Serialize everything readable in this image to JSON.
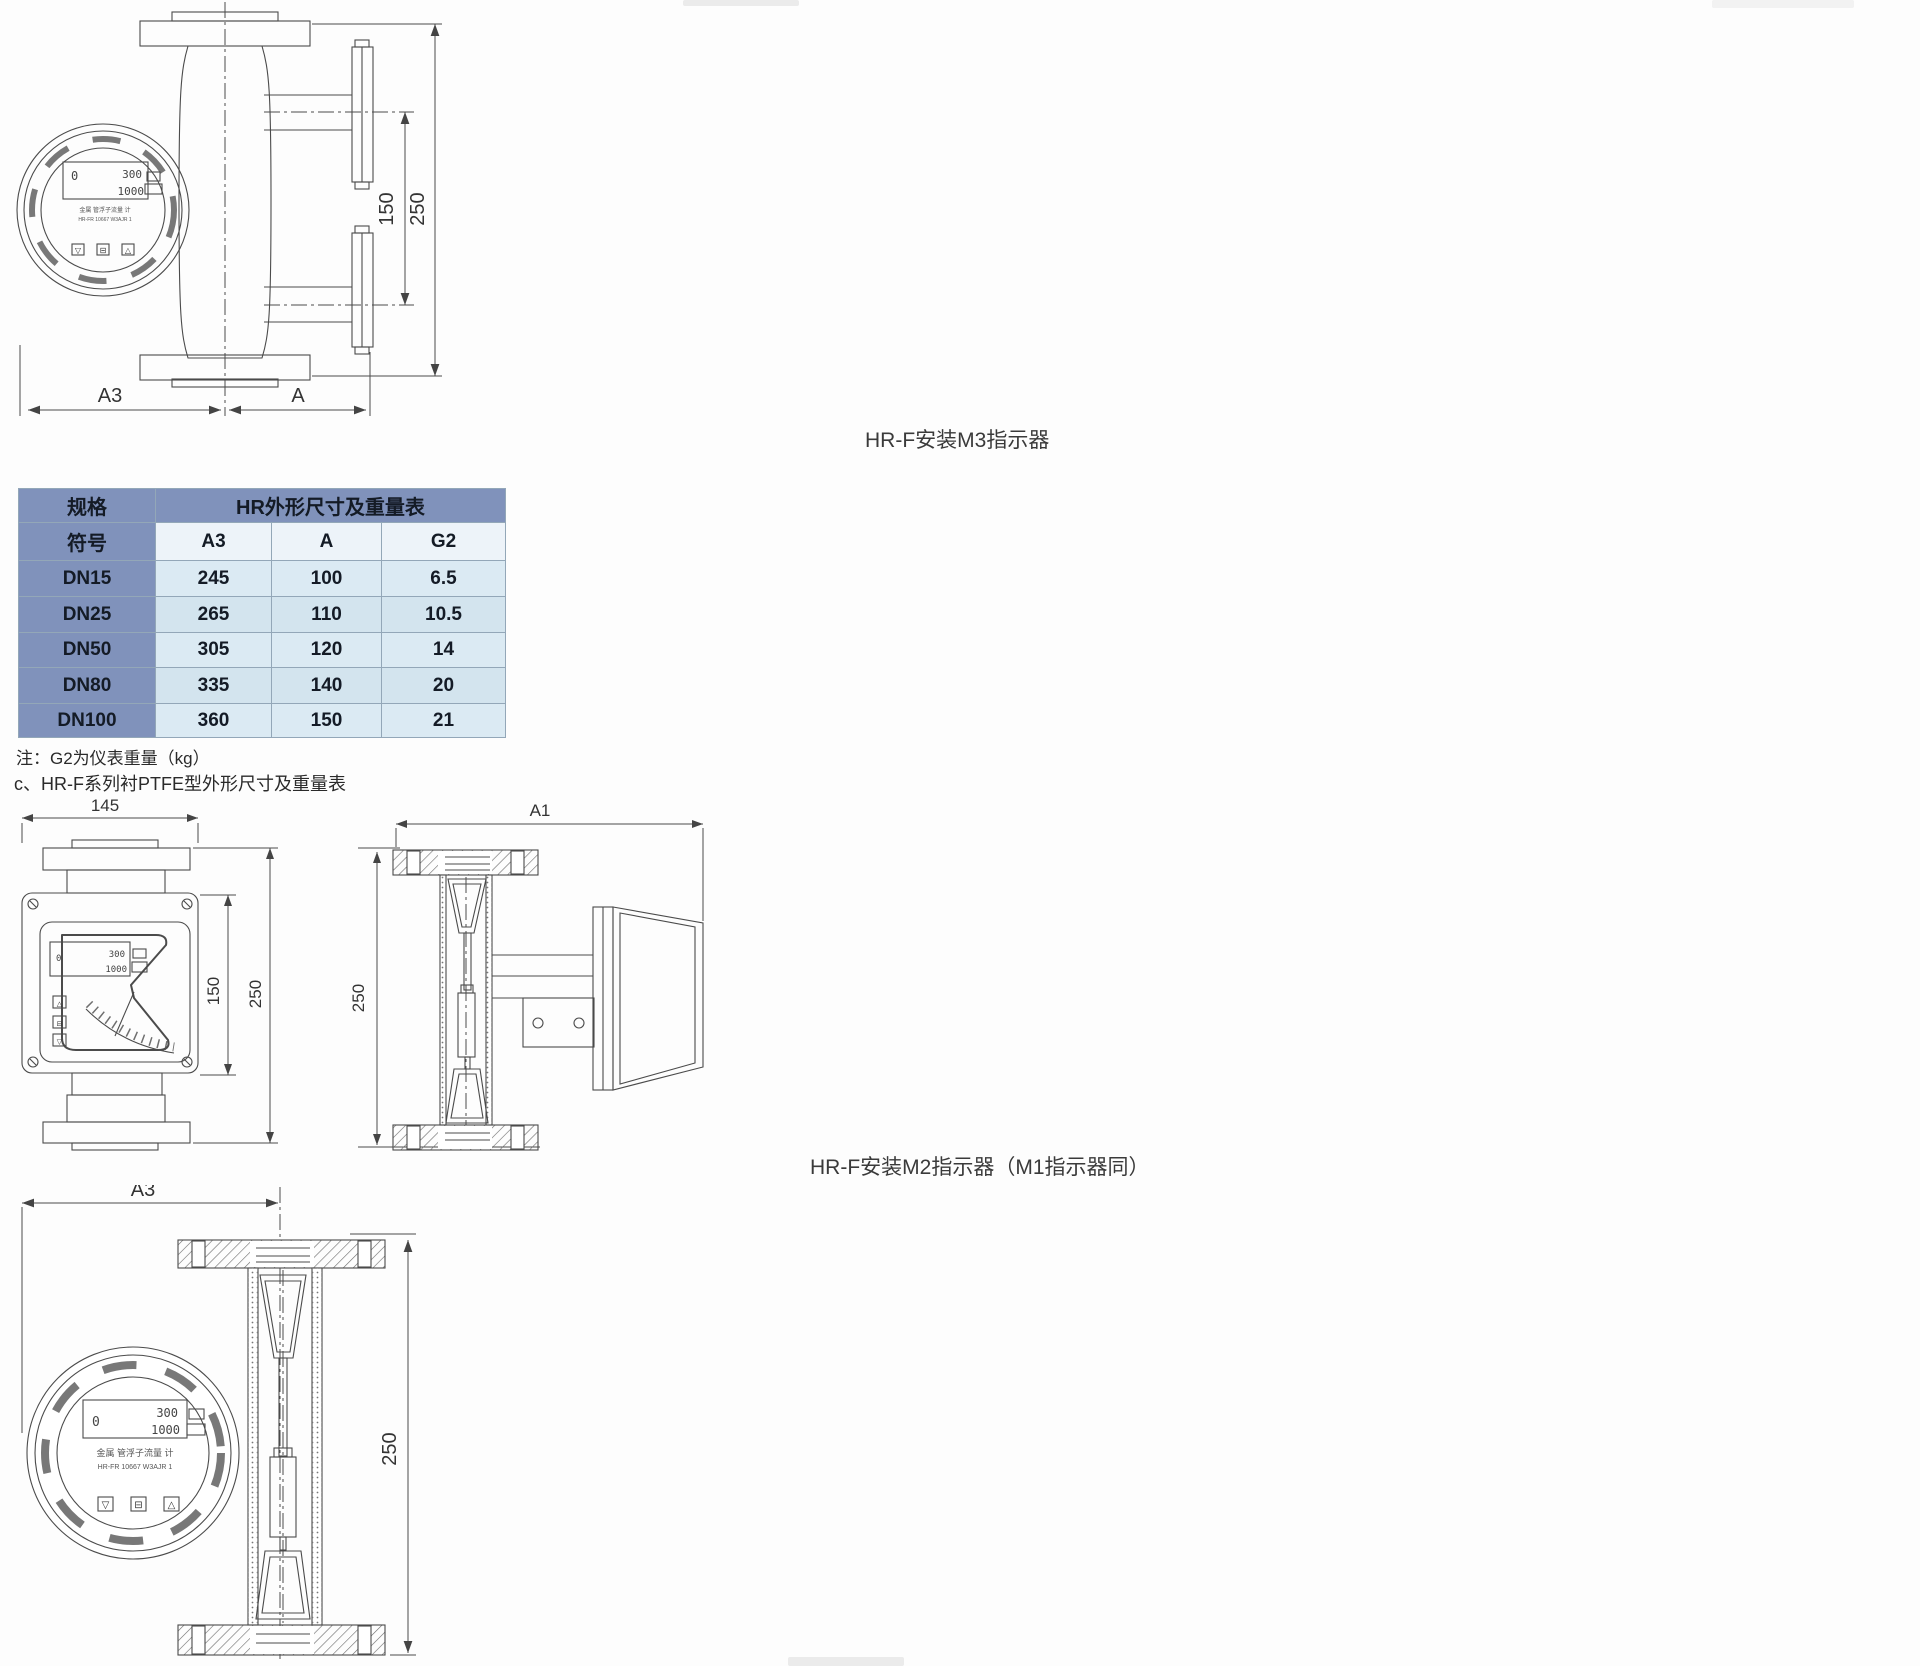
{
  "captions": {
    "m3": "HR-F安装M3指示器",
    "m2": "HR-F安装M2指示器（M1指示器同）",
    "note": "注：G2为仪表重量（kg）",
    "section_c": "c、HR-F系列衬PTFE型外形尺寸及重量表"
  },
  "table": {
    "corner_top": "规格",
    "corner_bottom": "符号",
    "title": "HR外形尺寸及重量表",
    "columns": [
      "A3",
      "A",
      "G2"
    ],
    "rows": [
      {
        "spec": "DN15",
        "a3": "245",
        "a": "100",
        "g2": "6.5"
      },
      {
        "spec": "DN25",
        "a3": "265",
        "a": "110",
        "g2": "10.5"
      },
      {
        "spec": "DN50",
        "a3": "305",
        "a": "120",
        "g2": "14"
      },
      {
        "spec": "DN80",
        "a3": "335",
        "a": "140",
        "g2": "20"
      },
      {
        "spec": "DN100",
        "a3": "360",
        "a": "150",
        "g2": "21"
      }
    ]
  },
  "dims": {
    "top": {
      "a3": "A3",
      "a": "A",
      "d150": "150",
      "d250": "250"
    },
    "mid_left": {
      "w": "145",
      "d150": "150",
      "d250": "250"
    },
    "mid_right": {
      "a1": "A1",
      "d250": "250"
    },
    "bottom": {
      "a3": "A3",
      "d250": "250"
    }
  },
  "indicator": {
    "lcd_zero": "0",
    "lcd_top": "300",
    "lcd_bottom": "1000",
    "caption1": "金属 管浮子流量 计",
    "caption2": "HR-FR 10667 W3AJR 1",
    "btn_down": "▽",
    "btn_mid": "⊟",
    "btn_up": "△"
  },
  "colors": {
    "header_blue": "#8092bb",
    "row_light": "#dbeaf3",
    "row_mid": "#d3e4ee",
    "subheader": "#edf3f9",
    "line": "#4b4b4b"
  }
}
